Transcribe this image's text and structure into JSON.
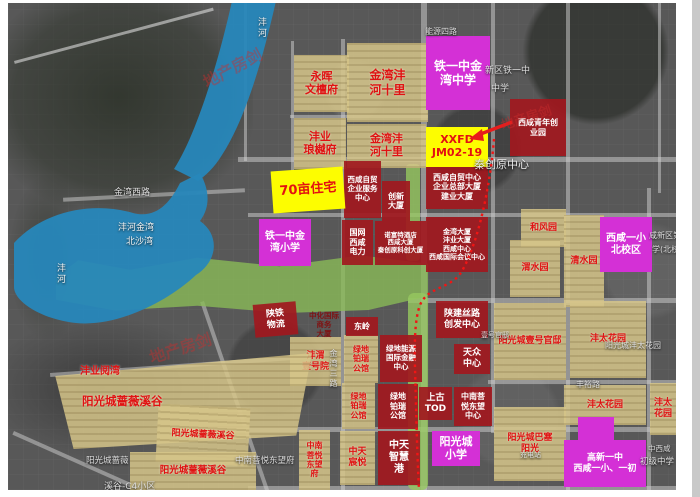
{
  "watermark": {
    "text": "地产房剑"
  },
  "blocks": {
    "yonghui_wentanfu": {
      "lines": [
        "永晖",
        "文檀府"
      ]
    },
    "jinwan_fenghe_shili_n": {
      "lines": [
        "金湾沣",
        "河十里"
      ]
    },
    "tieyizhong_jinwan_zhongxue": {
      "lines": [
        "铁一中金",
        "湾中学"
      ]
    },
    "fengye_langyuefu": {
      "lines": [
        "沣业",
        "琅樾府"
      ]
    },
    "jinwan_fenghe_shili_s": {
      "lines": [
        "金湾沣",
        "河十里"
      ]
    },
    "xxfd_jm0219": {
      "lines": [
        "XXFD",
        "JM02-19"
      ]
    },
    "xixian_qingnian_chuangyeyuan": {
      "lines": [
        "西咸青年创",
        "业园"
      ]
    },
    "qishimu_zhuzhai": {
      "lines": [
        "70亩住宅"
      ]
    },
    "zimao_fuwu": {
      "lines": [
        "西咸自贸",
        "企业服务",
        "中心"
      ]
    },
    "chuangxin_dasha": {
      "lines": [
        "创新",
        "大厦"
      ]
    },
    "zimao_zhongxin": {
      "lines": [
        "西咸自贸中心",
        "企业总部大厦",
        "建业大厦"
      ]
    },
    "tieyizhong_jinwan_xiaoxue": {
      "lines": [
        "铁一中金",
        "湾小学"
      ]
    },
    "guowang_dianli": {
      "lines": [
        "国网",
        "西咸",
        "电力"
      ]
    },
    "nuofute": {
      "lines": [
        "诺富特酒店",
        "西咸大厦",
        "秦创原科创大厦"
      ]
    },
    "jinwan_dasha": {
      "lines": [
        "金湾大厦",
        "沣业大厦",
        "西咸中心",
        "西咸国际会议中心"
      ]
    },
    "hefengyuan": {
      "lines": [
        "和风园"
      ]
    },
    "weishuiyuan": {
      "lines": [
        "渭水园"
      ]
    },
    "qingshuiyuan": {
      "lines": [
        "清水园"
      ]
    },
    "yixiao_beixiaoqu": {
      "lines": [
        "西咸一小",
        "北校区"
      ]
    },
    "shaanjian_silu": {
      "lines": [
        "陕建丝路",
        "创发中心"
      ]
    },
    "tianzhong_zhongxin": {
      "lines": [
        "天众",
        "中心"
      ]
    },
    "dongling": {
      "lines": [
        "东岭"
      ]
    },
    "shantie_wuliu": {
      "lines": [
        "陕铁",
        "物流"
      ]
    },
    "zhonghua_shangwu": {
      "lines": [
        "中化国际",
        "商务",
        "大厦"
      ]
    },
    "fengwei_yihaoyuan": {
      "lines": [
        "沣渭",
        "壹号院"
      ]
    },
    "lvdi_borui_guan_a": {
      "lines": [
        "绿地",
        "铂瑞",
        "公馆"
      ]
    },
    "lvdi_nengyuan": {
      "lines": [
        "绿地能源",
        "国际金融",
        "中心"
      ]
    },
    "lvdi_borui_guan_b": {
      "lines": [
        "绿地",
        "铂瑞",
        "公馆"
      ]
    },
    "lvdi_borui_guan_c": {
      "lines": [
        "绿地",
        "铂瑞",
        "公馆"
      ]
    },
    "zhongtian_zhihuigang": {
      "lines": [
        "中天",
        "智慧",
        "港"
      ]
    },
    "zhongtian_chenyue": {
      "lines": [
        "中天",
        "宸悦"
      ]
    },
    "zhongnan_dongwangfu": {
      "lines": [
        "中南",
        "菩悦",
        "东望",
        "府"
      ]
    },
    "shanggu_tod": {
      "lines": [
        "上古",
        "TOD"
      ]
    },
    "zhongnan_dongwang_center": {
      "lines": [
        "中南菩",
        "悦东望",
        "中心"
      ]
    },
    "yangguangcheng_xiaoxue": {
      "lines": [
        "阳光城",
        "小学"
      ]
    },
    "gaoxin_yizhong": {
      "lines": [
        "高新一中",
        "西咸一小、一初"
      ]
    },
    "fengye_yuewan": {
      "lines": [
        "沣业阅湾"
      ]
    },
    "qiangwei_xigu_1": {
      "lines": [
        "阳光城蔷薇溪谷"
      ]
    },
    "qiangwei_xigu_2": {
      "lines": [
        "阳光城蔷薇溪谷"
      ]
    },
    "qiangwei_xigu_3": {
      "lines": [
        "阳光城蔷薇溪谷"
      ]
    },
    "yihao_guandi": {
      "lines": [
        "阳光城壹号官邸"
      ]
    },
    "fengtai_huayuan_1": {
      "lines": [
        "沣太花园"
      ]
    },
    "fengtai_huayuan_2": {
      "lines": [
        "沣太花园"
      ]
    },
    "fengtai_huayuan_3": {
      "lines": [
        "沣太",
        "花园"
      ]
    },
    "basai_yangguang": {
      "lines": [
        "阳光城巴塞",
        "阳光"
      ]
    }
  },
  "map_labels": {
    "jinwan_xilu": "金湾西路",
    "nengyuan_silu": "能源四路",
    "qinchuangyuan_zhongxin": "秦创原中心",
    "fengyu_lu": "丰裕路",
    "jinwan_sanlu": "金湾三路",
    "xinqu_tieyizhong": "新区铁一中",
    "zhongxue": "中学",
    "xian_xinqu_di": "咸新区第",
    "xue_beixiao": "学(北校",
    "yihao_guandi_bg": "壹号官邸",
    "yangguang_fengtai_bg": "阳光城沣太花园",
    "zhongnan_dongwangfu_bg": "中南菩悦东望府",
    "qiangwei_bg_1": "阳光城蔷薇",
    "qiangwei_bg_2": "溪谷-C4小区",
    "zhongxixian": "中西咸",
    "chuji_zhongxue": "初级中学",
    "chongdianzhan": "充电站",
    "fenghe_jinwan": "沣河金湾",
    "beishawan": "北沙湾",
    "fenghe_v1": "沣河",
    "fenghe_v2": "沣河"
  },
  "colors": {
    "residential_tan": "#d6c589",
    "commercial_red": "#a1181e",
    "school_magenta": "#d430d6",
    "highlight_yellow": "#fdfd00",
    "park_green": "#8aba58",
    "water_blue": "#2787bb",
    "boundary_red": "#f01515"
  }
}
